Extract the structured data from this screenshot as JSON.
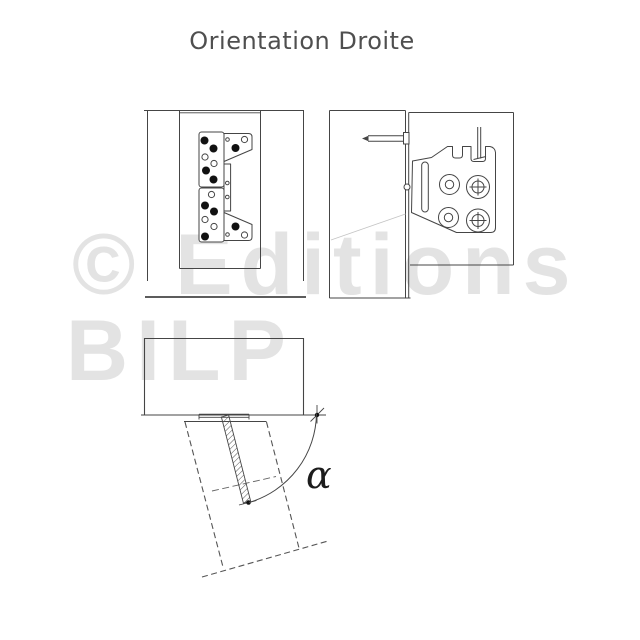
{
  "page": {
    "title": "Orientation Droite"
  },
  "watermark": {
    "line1": "© Editions",
    "line2": "BILP",
    "color": "#e3e3e3"
  },
  "diagram": {
    "angle_label": "α"
  },
  "colors": {
    "line": "#454545",
    "title": "#4f4f4f",
    "watermark": "#e3e3e3",
    "alpha": "#1c1c1c"
  }
}
